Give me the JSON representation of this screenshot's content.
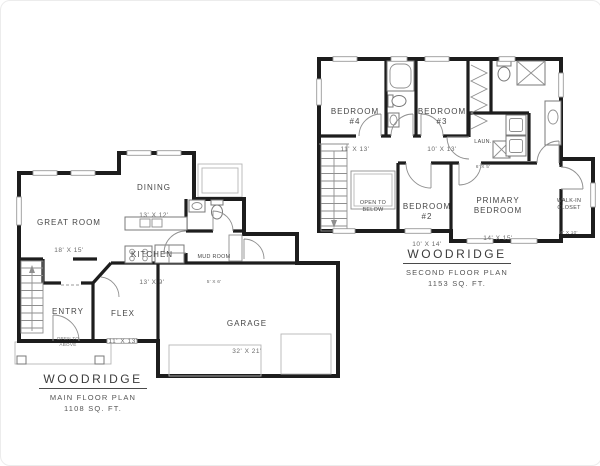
{
  "sheet": {
    "background": "#ffffff"
  },
  "colors": {
    "wall_ink": "#1d1d1d",
    "thin_line": "#8f8f8f",
    "label_text": "#474747"
  },
  "main_floor_plan": {
    "title": "WOODRIDGE",
    "subtitle": "MAIN FLOOR PLAN",
    "area": "1108 SQ. FT.",
    "rooms": {
      "great_room": {
        "name": "GREAT ROOM",
        "dims": "18' X 15'"
      },
      "dining": {
        "name": "DINING",
        "dims": "13' X 12'"
      },
      "kitchen": {
        "name": "KITCHEN",
        "dims": "13' X 9'"
      },
      "mud_room": {
        "name": "MUD ROOM",
        "dims": "5' X 6'"
      },
      "entry": {
        "name": "ENTRY",
        "note": "OPEN TO\nABOVE"
      },
      "flex": {
        "name": "FLEX",
        "dims": "11' X 13'"
      },
      "garage": {
        "name": "GARAGE",
        "dims": "32' X 21'"
      }
    }
  },
  "second_floor_plan": {
    "title": "WOODRIDGE",
    "subtitle": "SECOND FLOOR PLAN",
    "area": "1153 SQ. FT.",
    "rooms": {
      "bedroom_4": {
        "name": "BEDROOM\n#4",
        "dims": "11' X 13'"
      },
      "bedroom_3": {
        "name": "BEDROOM\n#3",
        "dims": "10' X 13'"
      },
      "laundry": {
        "name": "LAUN.",
        "dims": "6' X 5'"
      },
      "open_to_below": {
        "name": "OPEN TO\nBELOW"
      },
      "bedroom_2": {
        "name": "BEDROOM\n#2",
        "dims": "10' X 14'"
      },
      "primary_bedroom": {
        "name": "PRIMARY\nBEDROOM",
        "dims": "14' X 15'"
      },
      "walk_in_closet": {
        "name": "WALK-IN\nCLOSET",
        "dims": "6' X 10'"
      }
    }
  }
}
